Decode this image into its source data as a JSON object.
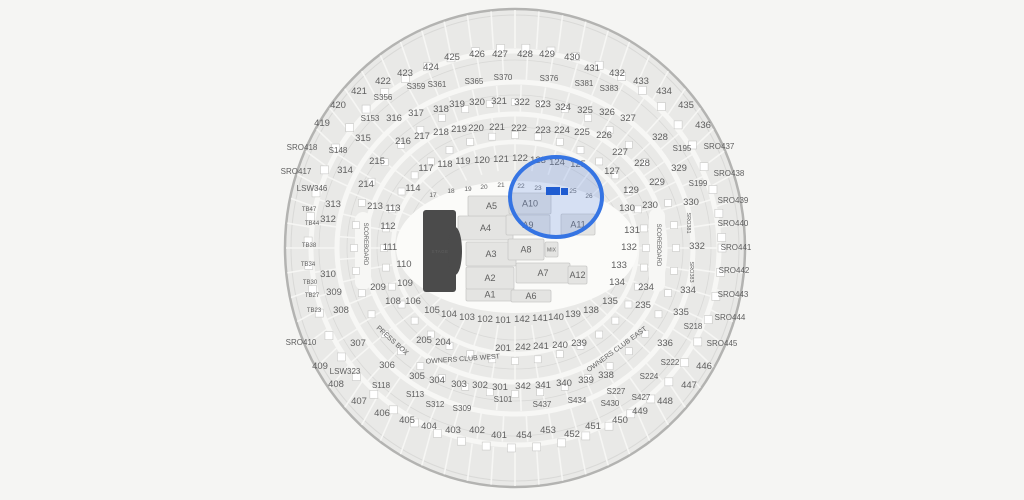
{
  "map": {
    "background": "#f5f5f3",
    "section_fill": "#e9e9e7",
    "outline_color": "#b3b3b1",
    "label_color": "#5f5f5f",
    "stage": {
      "label": "STAGE",
      "color": "#4b4b4b"
    },
    "selection": {
      "cx": 556,
      "cy": 197,
      "rx": 46,
      "ry": 40,
      "ring_color": "#3574e3",
      "fill_color": "rgba(105,143,226,0.25)",
      "marker_color": "#1f5cd1",
      "markers": [
        {
          "x": 546,
          "y": 187,
          "w": 14,
          "h": 8
        },
        {
          "x": 561,
          "y": 188,
          "w": 7,
          "h": 7
        }
      ]
    },
    "floor_sections": [
      {
        "label": "A1",
        "x": 466,
        "y": 288,
        "w": 48,
        "h": 13
      },
      {
        "label": "A2",
        "x": 466,
        "y": 267,
        "w": 48,
        "h": 22
      },
      {
        "label": "A3",
        "x": 466,
        "y": 242,
        "w": 50,
        "h": 24
      },
      {
        "label": "A4",
        "x": 458,
        "y": 216,
        "w": 55,
        "h": 24
      },
      {
        "label": "A5",
        "x": 468,
        "y": 196,
        "w": 47,
        "h": 20
      },
      {
        "label": "A6",
        "x": 511,
        "y": 290,
        "w": 40,
        "h": 12
      },
      {
        "label": "A7",
        "x": 516,
        "y": 263,
        "w": 54,
        "h": 20
      },
      {
        "label": "A8",
        "x": 508,
        "y": 239,
        "w": 36,
        "h": 21
      },
      {
        "label": "A9",
        "x": 506,
        "y": 215,
        "w": 44,
        "h": 20
      },
      {
        "label": "A10",
        "x": 509,
        "y": 193,
        "w": 42,
        "h": 21
      },
      {
        "label": "A11",
        "x": 561,
        "y": 214,
        "w": 34,
        "h": 21
      },
      {
        "label": "A12",
        "x": 568,
        "y": 266,
        "w": 19,
        "h": 18
      },
      {
        "label": "MIX",
        "x": 545,
        "y": 242,
        "w": 13,
        "h": 15,
        "s": 5
      }
    ],
    "labels": [
      {
        "t": "101",
        "x": 503,
        "y": 323
      },
      {
        "t": "102",
        "x": 485,
        "y": 322
      },
      {
        "t": "103",
        "x": 467,
        "y": 320
      },
      {
        "t": "104",
        "x": 449,
        "y": 317
      },
      {
        "t": "105",
        "x": 432,
        "y": 313
      },
      {
        "t": "106",
        "x": 413,
        "y": 304
      },
      {
        "t": "108",
        "x": 393,
        "y": 304
      },
      {
        "t": "109",
        "x": 405,
        "y": 286
      },
      {
        "t": "110",
        "x": 404,
        "y": 267
      },
      {
        "t": "111",
        "x": 390,
        "y": 250
      },
      {
        "t": "112",
        "x": 388,
        "y": 229
      },
      {
        "t": "113",
        "x": 393,
        "y": 211
      },
      {
        "t": "114",
        "x": 413,
        "y": 191
      },
      {
        "t": "117",
        "x": 426,
        "y": 171
      },
      {
        "t": "118",
        "x": 445,
        "y": 167
      },
      {
        "t": "119",
        "x": 463,
        "y": 164
      },
      {
        "t": "120",
        "x": 482,
        "y": 163
      },
      {
        "t": "121",
        "x": 501,
        "y": 162
      },
      {
        "t": "122",
        "x": 520,
        "y": 161
      },
      {
        "t": "123",
        "x": 538,
        "y": 163
      },
      {
        "t": "124",
        "x": 557,
        "y": 165
      },
      {
        "t": "125",
        "x": 578,
        "y": 167
      },
      {
        "t": "127",
        "x": 612,
        "y": 174
      },
      {
        "t": "129",
        "x": 631,
        "y": 193
      },
      {
        "t": "130",
        "x": 627,
        "y": 211
      },
      {
        "t": "131",
        "x": 632,
        "y": 233
      },
      {
        "t": "132",
        "x": 629,
        "y": 250
      },
      {
        "t": "133",
        "x": 619,
        "y": 268
      },
      {
        "t": "134",
        "x": 617,
        "y": 285
      },
      {
        "t": "135",
        "x": 610,
        "y": 304
      },
      {
        "t": "138",
        "x": 591,
        "y": 313
      },
      {
        "t": "139",
        "x": 573,
        "y": 317
      },
      {
        "t": "140",
        "x": 556,
        "y": 320
      },
      {
        "t": "141",
        "x": 540,
        "y": 321
      },
      {
        "t": "142",
        "x": 522,
        "y": 322
      },
      {
        "t": "201",
        "x": 503,
        "y": 351
      },
      {
        "t": "204",
        "x": 443,
        "y": 345
      },
      {
        "t": "205",
        "x": 424,
        "y": 343
      },
      {
        "t": "209",
        "x": 378,
        "y": 290
      },
      {
        "t": "213",
        "x": 375,
        "y": 209
      },
      {
        "t": "214",
        "x": 366,
        "y": 187
      },
      {
        "t": "215",
        "x": 377,
        "y": 164
      },
      {
        "t": "216",
        "x": 403,
        "y": 144
      },
      {
        "t": "217",
        "x": 422,
        "y": 139
      },
      {
        "t": "218",
        "x": 441,
        "y": 135
      },
      {
        "t": "219",
        "x": 459,
        "y": 132
      },
      {
        "t": "220",
        "x": 476,
        "y": 131
      },
      {
        "t": "221",
        "x": 497,
        "y": 130
      },
      {
        "t": "222",
        "x": 519,
        "y": 131
      },
      {
        "t": "223",
        "x": 543,
        "y": 133
      },
      {
        "t": "224",
        "x": 562,
        "y": 133
      },
      {
        "t": "225",
        "x": 582,
        "y": 135
      },
      {
        "t": "226",
        "x": 604,
        "y": 138
      },
      {
        "t": "227",
        "x": 620,
        "y": 155
      },
      {
        "t": "228",
        "x": 642,
        "y": 166
      },
      {
        "t": "229",
        "x": 657,
        "y": 185
      },
      {
        "t": "230",
        "x": 650,
        "y": 208
      },
      {
        "t": "234",
        "x": 646,
        "y": 290
      },
      {
        "t": "235",
        "x": 643,
        "y": 308
      },
      {
        "t": "239",
        "x": 579,
        "y": 346
      },
      {
        "t": "240",
        "x": 560,
        "y": 348
      },
      {
        "t": "241",
        "x": 541,
        "y": 349
      },
      {
        "t": "242",
        "x": 523,
        "y": 350
      },
      {
        "t": "301",
        "x": 500,
        "y": 390
      },
      {
        "t": "302",
        "x": 480,
        "y": 388
      },
      {
        "t": "303",
        "x": 459,
        "y": 387
      },
      {
        "t": "304",
        "x": 437,
        "y": 383
      },
      {
        "t": "305",
        "x": 417,
        "y": 379
      },
      {
        "t": "306",
        "x": 387,
        "y": 368
      },
      {
        "t": "307",
        "x": 358,
        "y": 346
      },
      {
        "t": "308",
        "x": 341,
        "y": 313
      },
      {
        "t": "309",
        "x": 334,
        "y": 295
      },
      {
        "t": "310",
        "x": 328,
        "y": 277
      },
      {
        "t": "312",
        "x": 328,
        "y": 222
      },
      {
        "t": "313",
        "x": 333,
        "y": 207
      },
      {
        "t": "314",
        "x": 345,
        "y": 173
      },
      {
        "t": "315",
        "x": 363,
        "y": 141
      },
      {
        "t": "316",
        "x": 394,
        "y": 121
      },
      {
        "t": "317",
        "x": 416,
        "y": 116
      },
      {
        "t": "318",
        "x": 441,
        "y": 112
      },
      {
        "t": "319",
        "x": 457,
        "y": 107
      },
      {
        "t": "320",
        "x": 477,
        "y": 105
      },
      {
        "t": "321",
        "x": 499,
        "y": 104
      },
      {
        "t": "322",
        "x": 522,
        "y": 105
      },
      {
        "t": "323",
        "x": 543,
        "y": 107
      },
      {
        "t": "324",
        "x": 563,
        "y": 110
      },
      {
        "t": "325",
        "x": 585,
        "y": 113
      },
      {
        "t": "326",
        "x": 607,
        "y": 115
      },
      {
        "t": "327",
        "x": 628,
        "y": 121
      },
      {
        "t": "328",
        "x": 660,
        "y": 140
      },
      {
        "t": "329",
        "x": 679,
        "y": 171
      },
      {
        "t": "330",
        "x": 691,
        "y": 205
      },
      {
        "t": "332",
        "x": 697,
        "y": 249
      },
      {
        "t": "334",
        "x": 688,
        "y": 293
      },
      {
        "t": "335",
        "x": 681,
        "y": 315
      },
      {
        "t": "336",
        "x": 665,
        "y": 346
      },
      {
        "t": "338",
        "x": 606,
        "y": 378
      },
      {
        "t": "339",
        "x": 586,
        "y": 383
      },
      {
        "t": "340",
        "x": 564,
        "y": 386
      },
      {
        "t": "341",
        "x": 543,
        "y": 388
      },
      {
        "t": "342",
        "x": 523,
        "y": 389
      },
      {
        "t": "401",
        "x": 499,
        "y": 438
      },
      {
        "t": "402",
        "x": 477,
        "y": 433
      },
      {
        "t": "403",
        "x": 453,
        "y": 433
      },
      {
        "t": "404",
        "x": 429,
        "y": 429
      },
      {
        "t": "405",
        "x": 407,
        "y": 423
      },
      {
        "t": "406",
        "x": 382,
        "y": 416
      },
      {
        "t": "407",
        "x": 359,
        "y": 404
      },
      {
        "t": "408",
        "x": 336,
        "y": 387
      },
      {
        "t": "409",
        "x": 320,
        "y": 369
      },
      {
        "t": "419",
        "x": 322,
        "y": 126
      },
      {
        "t": "420",
        "x": 338,
        "y": 108
      },
      {
        "t": "421",
        "x": 359,
        "y": 94
      },
      {
        "t": "422",
        "x": 383,
        "y": 84
      },
      {
        "t": "423",
        "x": 405,
        "y": 76
      },
      {
        "t": "424",
        "x": 431,
        "y": 70
      },
      {
        "t": "425",
        "x": 452,
        "y": 60
      },
      {
        "t": "426",
        "x": 477,
        "y": 57
      },
      {
        "t": "427",
        "x": 500,
        "y": 57
      },
      {
        "t": "428",
        "x": 525,
        "y": 57
      },
      {
        "t": "429",
        "x": 547,
        "y": 57
      },
      {
        "t": "430",
        "x": 572,
        "y": 60
      },
      {
        "t": "431",
        "x": 592,
        "y": 71
      },
      {
        "t": "432",
        "x": 617,
        "y": 76
      },
      {
        "t": "433",
        "x": 641,
        "y": 84
      },
      {
        "t": "434",
        "x": 664,
        "y": 94
      },
      {
        "t": "435",
        "x": 686,
        "y": 108
      },
      {
        "t": "436",
        "x": 703,
        "y": 128
      },
      {
        "t": "446",
        "x": 704,
        "y": 369
      },
      {
        "t": "447",
        "x": 689,
        "y": 388
      },
      {
        "t": "448",
        "x": 665,
        "y": 404
      },
      {
        "t": "449",
        "x": 640,
        "y": 414
      },
      {
        "t": "450",
        "x": 620,
        "y": 423
      },
      {
        "t": "451",
        "x": 593,
        "y": 429
      },
      {
        "t": "452",
        "x": 572,
        "y": 437
      },
      {
        "t": "453",
        "x": 548,
        "y": 433
      },
      {
        "t": "454",
        "x": 524,
        "y": 438
      },
      {
        "t": "SRO410",
        "x": 301,
        "y": 345,
        "s": 8
      },
      {
        "t": "SRO417",
        "x": 296,
        "y": 174,
        "s": 8
      },
      {
        "t": "SRO418",
        "x": 302,
        "y": 150,
        "s": 8
      },
      {
        "t": "SRO437",
        "x": 719,
        "y": 149,
        "s": 8
      },
      {
        "t": "SRO438",
        "x": 729,
        "y": 176,
        "s": 8
      },
      {
        "t": "SRO439",
        "x": 733,
        "y": 203,
        "s": 8
      },
      {
        "t": "SRO440",
        "x": 733,
        "y": 226,
        "s": 8
      },
      {
        "t": "SRO441",
        "x": 736,
        "y": 250,
        "s": 8
      },
      {
        "t": "SRO442",
        "x": 734,
        "y": 273,
        "s": 8
      },
      {
        "t": "SRO443",
        "x": 733,
        "y": 297,
        "s": 8
      },
      {
        "t": "SRO444",
        "x": 730,
        "y": 320,
        "s": 8
      },
      {
        "t": "SRO445",
        "x": 722,
        "y": 346,
        "s": 8
      },
      {
        "t": "LSW346",
        "x": 312,
        "y": 191,
        "s": 8
      },
      {
        "t": "LSW323",
        "x": 345,
        "y": 374,
        "s": 8
      },
      {
        "t": "S101",
        "x": 503,
        "y": 402,
        "s": 8
      },
      {
        "t": "S113",
        "x": 415,
        "y": 397,
        "s": 8
      },
      {
        "t": "S118",
        "x": 381,
        "y": 388,
        "s": 8
      },
      {
        "t": "S148",
        "x": 338,
        "y": 153,
        "s": 8
      },
      {
        "t": "S153",
        "x": 370,
        "y": 121,
        "s": 8
      },
      {
        "t": "S195",
        "x": 682,
        "y": 151,
        "s": 8
      },
      {
        "t": "S199",
        "x": 698,
        "y": 186,
        "s": 8
      },
      {
        "t": "S218",
        "x": 693,
        "y": 329,
        "s": 8
      },
      {
        "t": "S222",
        "x": 670,
        "y": 365,
        "s": 8
      },
      {
        "t": "S224",
        "x": 649,
        "y": 379,
        "s": 8
      },
      {
        "t": "S227",
        "x": 616,
        "y": 394,
        "s": 8
      },
      {
        "t": "S309",
        "x": 462,
        "y": 411,
        "s": 8
      },
      {
        "t": "S312",
        "x": 435,
        "y": 407,
        "s": 8
      },
      {
        "t": "S356",
        "x": 383,
        "y": 100,
        "s": 8
      },
      {
        "t": "S359",
        "x": 416,
        "y": 89,
        "s": 8
      },
      {
        "t": "S361",
        "x": 437,
        "y": 87,
        "s": 8
      },
      {
        "t": "S365",
        "x": 474,
        "y": 84,
        "s": 8
      },
      {
        "t": "S370",
        "x": 503,
        "y": 80,
        "s": 8
      },
      {
        "t": "S376",
        "x": 549,
        "y": 81,
        "s": 8
      },
      {
        "t": "S381",
        "x": 584,
        "y": 86,
        "s": 8
      },
      {
        "t": "S383",
        "x": 609,
        "y": 91,
        "s": 8
      },
      {
        "t": "S427",
        "x": 641,
        "y": 400,
        "s": 8
      },
      {
        "t": "S430",
        "x": 610,
        "y": 406,
        "s": 8
      },
      {
        "t": "S434",
        "x": 577,
        "y": 403,
        "s": 8
      },
      {
        "t": "S437",
        "x": 542,
        "y": 407,
        "s": 8
      },
      {
        "t": "TB47",
        "x": 309,
        "y": 211,
        "s": 6
      },
      {
        "t": "TB44",
        "x": 312,
        "y": 225,
        "s": 6
      },
      {
        "t": "TB38",
        "x": 309,
        "y": 247,
        "s": 6
      },
      {
        "t": "TB34",
        "x": 308,
        "y": 266,
        "s": 6
      },
      {
        "t": "TB30",
        "x": 310,
        "y": 284,
        "s": 6
      },
      {
        "t": "TB27",
        "x": 312,
        "y": 297,
        "s": 6
      },
      {
        "t": "TB23",
        "x": 314,
        "y": 312,
        "s": 6
      },
      {
        "t": "17",
        "x": 433,
        "y": 197,
        "s": 6.5
      },
      {
        "t": "18",
        "x": 451,
        "y": 193,
        "s": 6.5
      },
      {
        "t": "19",
        "x": 468,
        "y": 191,
        "s": 6.5
      },
      {
        "t": "20",
        "x": 484,
        "y": 189,
        "s": 6.5
      },
      {
        "t": "21",
        "x": 501,
        "y": 187,
        "s": 6.5
      },
      {
        "t": "22",
        "x": 521,
        "y": 188,
        "s": 6.5
      },
      {
        "t": "23",
        "x": 538,
        "y": 190,
        "s": 6.5
      },
      {
        "t": "24",
        "x": 555,
        "y": 192,
        "s": 6.5
      },
      {
        "t": "25",
        "x": 573,
        "y": 193,
        "s": 6.5
      },
      {
        "t": "26",
        "x": 589,
        "y": 198,
        "s": 6.5
      },
      {
        "t": "SCOREBOARD",
        "x": 364,
        "y": 244,
        "s": 6,
        "r": 90
      },
      {
        "t": "SCOREBOARD",
        "x": 657,
        "y": 245,
        "s": 6,
        "r": 90
      },
      {
        "t": "SRO381",
        "x": 687,
        "y": 223,
        "s": 5.5,
        "r": 90
      },
      {
        "t": "SRO383",
        "x": 690,
        "y": 272,
        "s": 5.5,
        "r": 90
      },
      {
        "t": "PRESS BOX",
        "x": 391,
        "y": 342,
        "s": 7,
        "r": 42
      },
      {
        "t": "OWNERS CLUB WEST",
        "x": 463,
        "y": 361,
        "s": 7,
        "r": -4
      },
      {
        "t": "OWNERS CLUB EAST",
        "x": 618,
        "y": 351,
        "s": 7,
        "r": -36
      }
    ]
  }
}
